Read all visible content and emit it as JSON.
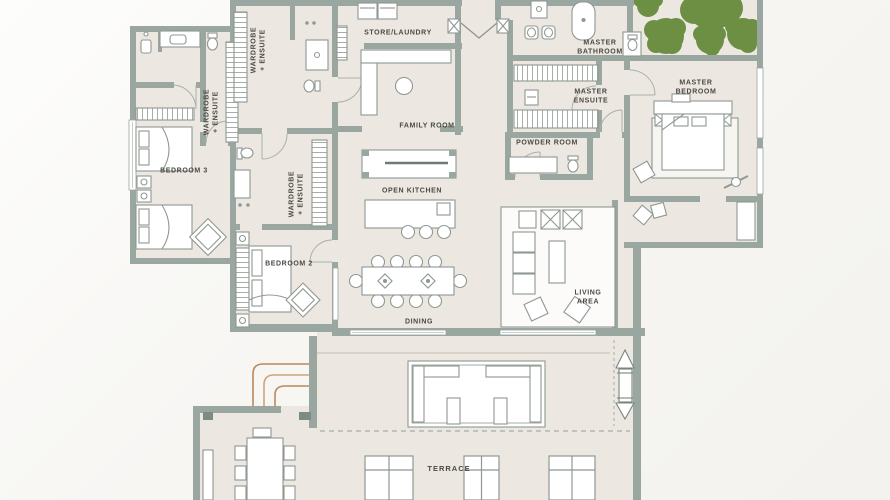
{
  "plan": {
    "type": "apartment-floor-plan",
    "colors": {
      "wall": "#9aa6a0",
      "floor": "#ece8e1",
      "background": "#f8f7f5",
      "tree_green": "#6d8f44",
      "steps_brown": "#b9895f",
      "label_text": "#4a4944",
      "furniture_line": "#8f9892"
    },
    "labels": {
      "wardrobe_a": "WARDROBE\n+ ENSUITE",
      "wardrobe_b": "WARDROBE\n+ ENSUITE",
      "wardrobe_c": "WARDROBE\n+ ENSUITE",
      "store_laundry": "STORE/LAUNDRY",
      "family_room": "FAMILY ROOM",
      "master_bathroom": "MASTER\nBATHROOM",
      "master_ensuite": "MASTER\nENSUITE",
      "powder_room": "POWDER ROOM",
      "master_bedroom": "MASTER\nBEDROOM",
      "bedroom_3": "BEDROOM 3",
      "bedroom_2": "BEDROOM 2",
      "open_kitchen": "OPEN KITCHEN",
      "dining": "DINING",
      "living_area": "LIVING\nAREA",
      "terrace": "TERRACE"
    }
  }
}
